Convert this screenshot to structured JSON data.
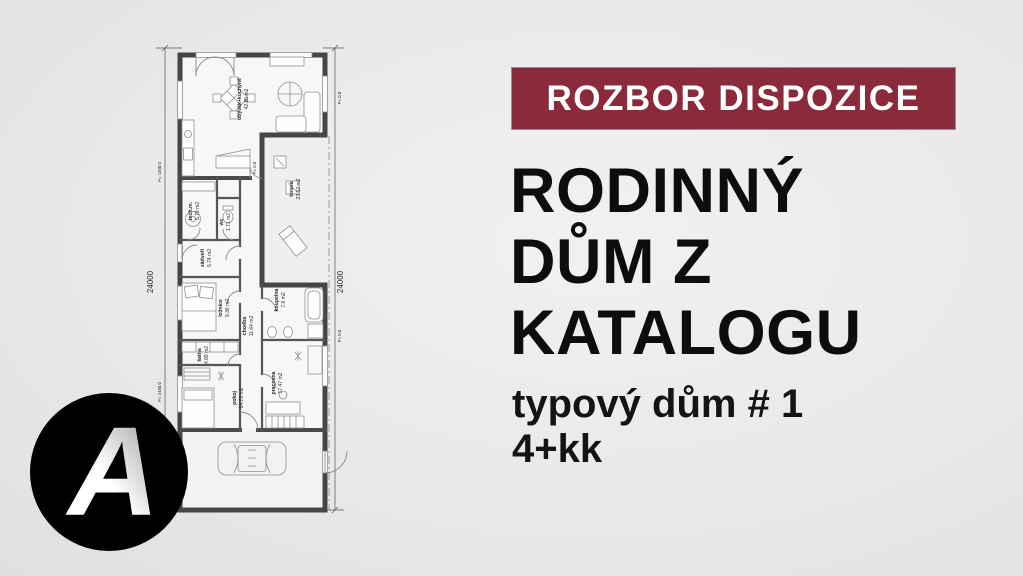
{
  "banner": {
    "label": "ROZBOR DISPOZICE",
    "bg_color": "#8b2a3b",
    "text_color": "#ffffff"
  },
  "title": {
    "lines": [
      "RODINNÝ",
      "DŮM Z",
      "KATALOGU"
    ],
    "color": "#0d0d0d"
  },
  "subtitle": {
    "line1": "typový dům # 1",
    "line2": "4+kk",
    "color": "#141414"
  },
  "logo": {
    "letter": "A",
    "bg_color": "#000000",
    "letter_color": "#ffffff"
  },
  "floor_plan": {
    "rooms": [
      {
        "name": "obývák+kuchyně",
        "area": "42.85 m2"
      },
      {
        "name": "terasa",
        "area": "23.52 m2"
      },
      {
        "name": "tech.m.",
        "area": "5.79 m2"
      },
      {
        "name": "wc",
        "area": "1.71 m2"
      },
      {
        "name": "zádveří",
        "area": "5.74 m2"
      },
      {
        "name": "ložnice",
        "area": "9.36 m2"
      },
      {
        "name": "chodba",
        "area": "11.64 m2"
      },
      {
        "name": "koupelna",
        "area": "7.6 m2"
      },
      {
        "name": "šatna",
        "area": "4.89 m2"
      },
      {
        "name": "pokoj",
        "area": "14.73 m2"
      },
      {
        "name": "pracovna",
        "area": "17.47 m2"
      }
    ],
    "dimensions": {
      "left": "24000",
      "right": "24000"
    },
    "levels": {
      "raised": "P= 1450.0",
      "ground": "P= 0.0"
    }
  }
}
